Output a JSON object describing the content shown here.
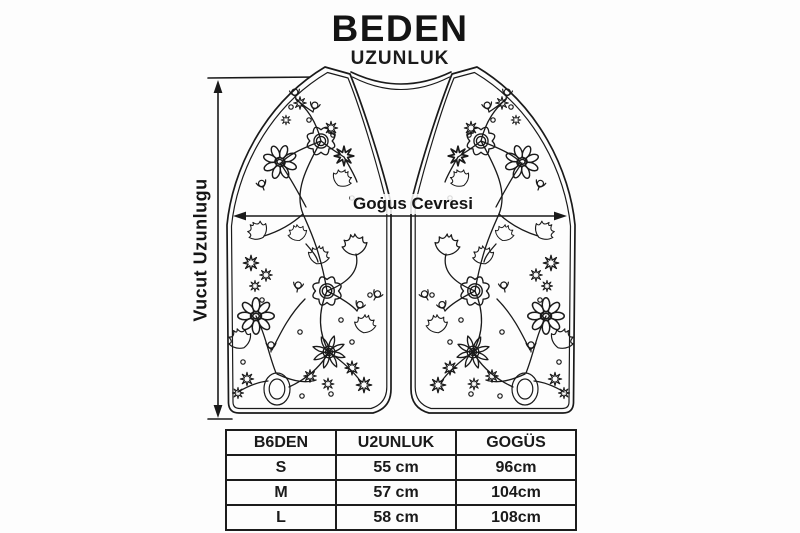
{
  "page": {
    "background": "#fdfdfd",
    "ink": "#1a1a1a"
  },
  "header": {
    "title": "BEDEN",
    "subtitle": "UZUNLUK"
  },
  "diagram": {
    "chest_label": "Goġus Cevresi",
    "body_length_label": "Vucut Uzunlugu",
    "subject": "embroidered-vest-line-drawing"
  },
  "size_table": {
    "columns": [
      "B6DEN",
      "U2UNLUK",
      "GOGÜS"
    ],
    "rows": [
      {
        "size": "S",
        "length": "55 cm",
        "chest": "96cm"
      },
      {
        "size": "M",
        "length": "57 cm",
        "chest": "104cm"
      },
      {
        "size": "L",
        "length": "58 cm",
        "chest": "108cm"
      }
    ]
  }
}
